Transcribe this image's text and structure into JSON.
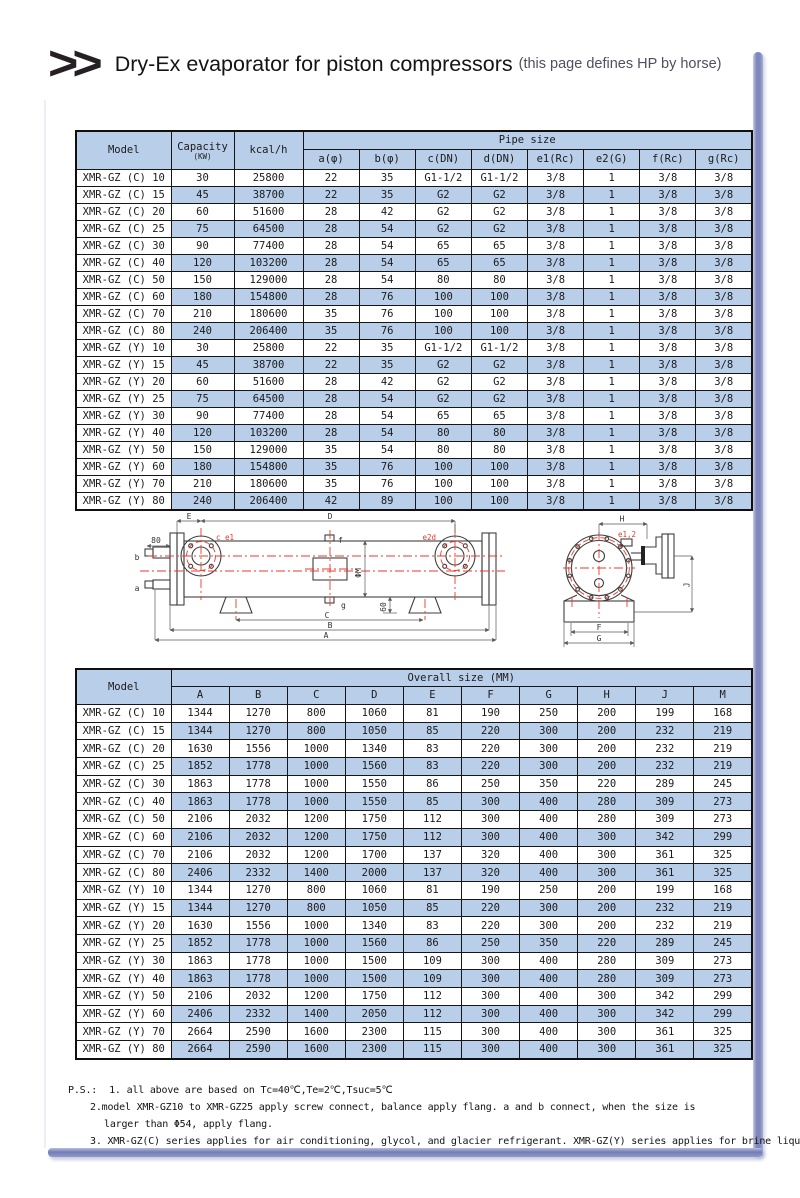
{
  "header": {
    "chevrons": ">>",
    "title": "Dry-Ex evaporator for piston compressors",
    "subtitle": "(this page defines HP by horse)"
  },
  "colors": {
    "cell_blue": "#b9cfe9",
    "frame_blue": "#7e88bd",
    "accent_red": "#e8392b",
    "line_dark": "#3f3f3f"
  },
  "table1": {
    "col_model": "Model",
    "col_capacity": "Capacity",
    "col_capacity_unit": "(KW)",
    "col_kcal": "kcal/h",
    "group_header": "Pipe size",
    "sub_headers": [
      "a(φ)",
      "b(φ)",
      "c(DN)",
      "d(DN)",
      "e1(Rc)",
      "e2(G)",
      "f(Rc)",
      "g(Rc)"
    ],
    "rows": [
      [
        "XMR-GZ (C) 10",
        "30",
        "25800",
        "22",
        "35",
        "G1-1/2",
        "G1-1/2",
        "3/8",
        "1",
        "3/8",
        "3/8"
      ],
      [
        "XMR-GZ (C) 15",
        "45",
        "38700",
        "22",
        "35",
        "G2",
        "G2",
        "3/8",
        "1",
        "3/8",
        "3/8"
      ],
      [
        "XMR-GZ (C) 20",
        "60",
        "51600",
        "28",
        "42",
        "G2",
        "G2",
        "3/8",
        "1",
        "3/8",
        "3/8"
      ],
      [
        "XMR-GZ (C) 25",
        "75",
        "64500",
        "28",
        "54",
        "G2",
        "G2",
        "3/8",
        "1",
        "3/8",
        "3/8"
      ],
      [
        "XMR-GZ (C) 30",
        "90",
        "77400",
        "28",
        "54",
        "65",
        "65",
        "3/8",
        "1",
        "3/8",
        "3/8"
      ],
      [
        "XMR-GZ (C) 40",
        "120",
        "103200",
        "28",
        "54",
        "65",
        "65",
        "3/8",
        "1",
        "3/8",
        "3/8"
      ],
      [
        "XMR-GZ (C) 50",
        "150",
        "129000",
        "28",
        "54",
        "80",
        "80",
        "3/8",
        "1",
        "3/8",
        "3/8"
      ],
      [
        "XMR-GZ (C) 60",
        "180",
        "154800",
        "28",
        "76",
        "100",
        "100",
        "3/8",
        "1",
        "3/8",
        "3/8"
      ],
      [
        "XMR-GZ (C) 70",
        "210",
        "180600",
        "35",
        "76",
        "100",
        "100",
        "3/8",
        "1",
        "3/8",
        "3/8"
      ],
      [
        "XMR-GZ (C) 80",
        "240",
        "206400",
        "35",
        "76",
        "100",
        "100",
        "3/8",
        "1",
        "3/8",
        "3/8"
      ],
      [
        "XMR-GZ (Y) 10",
        "30",
        "25800",
        "22",
        "35",
        "G1-1/2",
        "G1-1/2",
        "3/8",
        "1",
        "3/8",
        "3/8"
      ],
      [
        "XMR-GZ (Y) 15",
        "45",
        "38700",
        "22",
        "35",
        "G2",
        "G2",
        "3/8",
        "1",
        "3/8",
        "3/8"
      ],
      [
        "XMR-GZ (Y) 20",
        "60",
        "51600",
        "28",
        "42",
        "G2",
        "G2",
        "3/8",
        "1",
        "3/8",
        "3/8"
      ],
      [
        "XMR-GZ (Y) 25",
        "75",
        "64500",
        "28",
        "54",
        "G2",
        "G2",
        "3/8",
        "1",
        "3/8",
        "3/8"
      ],
      [
        "XMR-GZ (Y) 30",
        "90",
        "77400",
        "28",
        "54",
        "65",
        "65",
        "3/8",
        "1",
        "3/8",
        "3/8"
      ],
      [
        "XMR-GZ (Y) 40",
        "120",
        "103200",
        "28",
        "54",
        "80",
        "80",
        "3/8",
        "1",
        "3/8",
        "3/8"
      ],
      [
        "XMR-GZ (Y) 50",
        "150",
        "129000",
        "35",
        "54",
        "80",
        "80",
        "3/8",
        "1",
        "3/8",
        "3/8"
      ],
      [
        "XMR-GZ (Y) 60",
        "180",
        "154800",
        "35",
        "76",
        "100",
        "100",
        "3/8",
        "1",
        "3/8",
        "3/8"
      ],
      [
        "XMR-GZ (Y) 70",
        "210",
        "180600",
        "35",
        "76",
        "100",
        "100",
        "3/8",
        "1",
        "3/8",
        "3/8"
      ],
      [
        "XMR-GZ (Y) 80",
        "240",
        "206400",
        "42",
        "89",
        "100",
        "100",
        "3/8",
        "1",
        "3/8",
        "3/8"
      ]
    ]
  },
  "diagram": {
    "side_view": {
      "dim_e": "E",
      "dim_d": "D",
      "nozzle_ce1": "c e1",
      "nozzle_f": "f",
      "nozzle_e2d": "e2d",
      "dim_80": "80",
      "nozzle_b": "b",
      "nozzle_a": "a",
      "dim_phi_m": "ΦM",
      "nozzle_g": "g",
      "dim_60": "60",
      "dim_c": "C",
      "dim_b": "B",
      "dim_a": "A"
    },
    "end_view": {
      "dim_h": "H",
      "nozzle_e12": "e1,2",
      "dim_j": "J",
      "dim_f": "F",
      "dim_g": "G"
    }
  },
  "table2": {
    "col_model": "Model",
    "group_header": "Overall size (MM)",
    "sub_headers": [
      "A",
      "B",
      "C",
      "D",
      "E",
      "F",
      "G",
      "H",
      "J",
      "M"
    ],
    "rows": [
      [
        "XMR-GZ (C) 10",
        "1344",
        "1270",
        "800",
        "1060",
        "81",
        "190",
        "250",
        "200",
        "199",
        "168"
      ],
      [
        "XMR-GZ (C) 15",
        "1344",
        "1270",
        "800",
        "1050",
        "85",
        "220",
        "300",
        "200",
        "232",
        "219"
      ],
      [
        "XMR-GZ (C) 20",
        "1630",
        "1556",
        "1000",
        "1340",
        "83",
        "220",
        "300",
        "200",
        "232",
        "219"
      ],
      [
        "XMR-GZ (C) 25",
        "1852",
        "1778",
        "1000",
        "1560",
        "83",
        "220",
        "300",
        "200",
        "232",
        "219"
      ],
      [
        "XMR-GZ (C) 30",
        "1863",
        "1778",
        "1000",
        "1550",
        "86",
        "250",
        "350",
        "220",
        "289",
        "245"
      ],
      [
        "XMR-GZ (C) 40",
        "1863",
        "1778",
        "1000",
        "1550",
        "85",
        "300",
        "400",
        "280",
        "309",
        "273"
      ],
      [
        "XMR-GZ (C) 50",
        "2106",
        "2032",
        "1200",
        "1750",
        "112",
        "300",
        "400",
        "280",
        "309",
        "273"
      ],
      [
        "XMR-GZ (C) 60",
        "2106",
        "2032",
        "1200",
        "1750",
        "112",
        "300",
        "400",
        "300",
        "342",
        "299"
      ],
      [
        "XMR-GZ (C) 70",
        "2106",
        "2032",
        "1200",
        "1700",
        "137",
        "320",
        "400",
        "300",
        "361",
        "325"
      ],
      [
        "XMR-GZ (C) 80",
        "2406",
        "2332",
        "1400",
        "2000",
        "137",
        "320",
        "400",
        "300",
        "361",
        "325"
      ],
      [
        "XMR-GZ (Y) 10",
        "1344",
        "1270",
        "800",
        "1060",
        "81",
        "190",
        "250",
        "200",
        "199",
        "168"
      ],
      [
        "XMR-GZ (Y) 15",
        "1344",
        "1270",
        "800",
        "1050",
        "85",
        "220",
        "300",
        "200",
        "232",
        "219"
      ],
      [
        "XMR-GZ (Y) 20",
        "1630",
        "1556",
        "1000",
        "1340",
        "83",
        "220",
        "300",
        "200",
        "232",
        "219"
      ],
      [
        "XMR-GZ (Y) 25",
        "1852",
        "1778",
        "1000",
        "1560",
        "86",
        "250",
        "350",
        "220",
        "289",
        "245"
      ],
      [
        "XMR-GZ (Y) 30",
        "1863",
        "1778",
        "1000",
        "1500",
        "109",
        "300",
        "400",
        "280",
        "309",
        "273"
      ],
      [
        "XMR-GZ (Y) 40",
        "1863",
        "1778",
        "1000",
        "1500",
        "109",
        "300",
        "400",
        "280",
        "309",
        "273"
      ],
      [
        "XMR-GZ (Y) 50",
        "2106",
        "2032",
        "1200",
        "1750",
        "112",
        "300",
        "400",
        "300",
        "342",
        "299"
      ],
      [
        "XMR-GZ (Y) 60",
        "2406",
        "2332",
        "1400",
        "2050",
        "112",
        "300",
        "400",
        "300",
        "342",
        "299"
      ],
      [
        "XMR-GZ (Y) 70",
        "2664",
        "2590",
        "1600",
        "2300",
        "115",
        "300",
        "400",
        "300",
        "361",
        "325"
      ],
      [
        "XMR-GZ (Y) 80",
        "2664",
        "2590",
        "1600",
        "2300",
        "115",
        "300",
        "400",
        "300",
        "361",
        "325"
      ]
    ]
  },
  "notes": {
    "ps_label": "P.S.:",
    "item1": "1. all above are based on Tc=40℃,Te=2℃,Tsuc=5℃",
    "item2": "2.model XMR-GZ10 to XMR-GZ25 apply screw connect, balance apply flang. a and b connect, when the size is",
    "item3": "larger than Φ54, apply flang.",
    "item4": "3. XMR-GZ(C) series applies for air conditioning, glycol, and glacier refrigerant. XMR-GZ(Y) series applies for brine liquid."
  }
}
